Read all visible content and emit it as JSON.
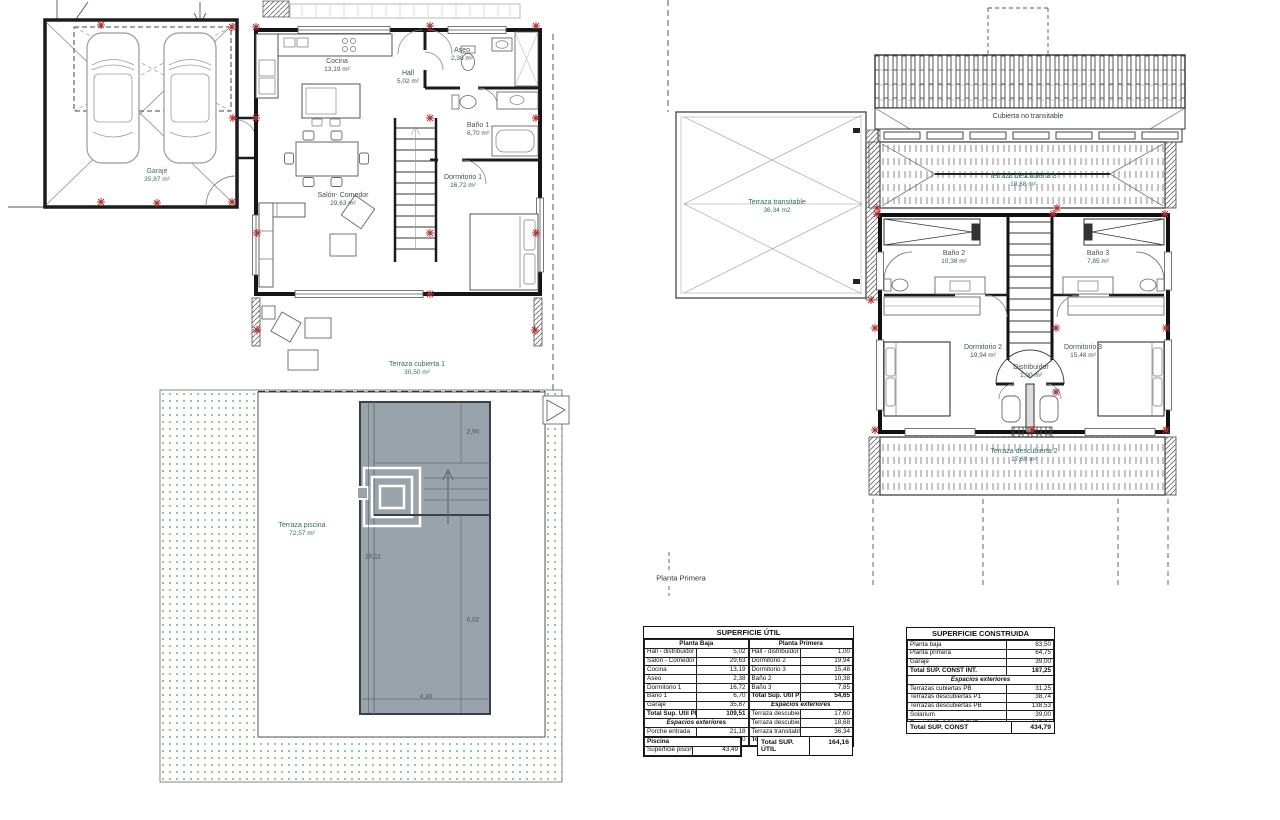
{
  "plans": {
    "ground": {
      "labels": {
        "garaje": {
          "name": "Garaje",
          "area": "35,87 m²"
        },
        "cocina": {
          "name": "Cocina",
          "area": "13,19 m²"
        },
        "hall": {
          "name": "Hall",
          "area": "5,02 m²"
        },
        "aseo": {
          "name": "Aseo",
          "area": "2,38 m²"
        },
        "bano1": {
          "name": "Baño 1",
          "area": "6,70 m²"
        },
        "dormitorio1": {
          "name": "Dormitorio 1",
          "area": "16,72 m²"
        },
        "salon": {
          "name": "Salón- Comedor",
          "area": "29,63 m²"
        },
        "terraza_cubierta1": {
          "name": "Terraza cubierta 1",
          "area": "30,50 m²"
        },
        "terraza_piscina": {
          "name": "Terraza piscina",
          "area": "72,57 m²"
        }
      },
      "pool": {
        "dims": {
          "d1": "2,90",
          "d2": "10,11",
          "d3": "6,02",
          "d4": "4,30"
        }
      }
    },
    "first": {
      "caption": "Planta Primera",
      "labels": {
        "cubierta": {
          "name": "Cubierta no transitable"
        },
        "terraza3": {
          "name": "Terraza descubierta 3",
          "area": "18,68 m²"
        },
        "terraza_transitable": {
          "name": "Terraza transitable",
          "area": "36,34 m2"
        },
        "bano2": {
          "name": "Baño 2",
          "area": "10,38 m²"
        },
        "bano3": {
          "name": "Baño 3",
          "area": "7,85 m²"
        },
        "dormitorio2": {
          "name": "Dormitorio 2",
          "area": "19,94 m²"
        },
        "dormitorio3": {
          "name": "Dormitorio 3",
          "area": "15,48 m²"
        },
        "distribuidor": {
          "name": "Distribuidor",
          "area": "1,00 m²"
        },
        "terraza2": {
          "name": "Terraza descubierta 2",
          "area": "17,60 m²"
        }
      }
    }
  },
  "tables": {
    "superficie_util": {
      "title": "SUPERFICIE ÚTIL",
      "planta_baja": {
        "header": "Planta Baja",
        "rows": [
          {
            "label": "Hall - distribuidor",
            "value": "5,02"
          },
          {
            "label": "Salón - Comedor",
            "value": "29,63"
          },
          {
            "label": "Cocina",
            "value": "13,19"
          },
          {
            "label": "Aseo",
            "value": "2,38"
          },
          {
            "label": "Dormitorio 1",
            "value": "16,72"
          },
          {
            "label": "Baño 1",
            "value": "6,70"
          },
          {
            "label": "Garaje",
            "value": "35,87"
          }
        ],
        "total": {
          "label": "Total Sup. Útil PB",
          "value": "109,51"
        },
        "exteriores_header": "Espacios exteriores",
        "exteriores_rows": [
          {
            "label": "Porche entrada",
            "value": "21,18"
          },
          {
            "label": "Terraza cubierta 1",
            "value": "30,50"
          }
        ]
      },
      "planta_primera": {
        "header": "Planta Primera",
        "rows": [
          {
            "label": "Hall - distribuidor",
            "value": "1,00"
          },
          {
            "label": "Dormitorio 2",
            "value": "19,94"
          },
          {
            "label": "Dormitorio 3",
            "value": "15,48"
          },
          {
            "label": "Baño 2",
            "value": "10,38"
          },
          {
            "label": "Baño 3",
            "value": "7,85"
          }
        ],
        "total": {
          "label": "Total Sup. Útil P1",
          "value": "54,65"
        },
        "exteriores_header": "Espacios exteriores",
        "exteriores_rows": [
          {
            "label": "Terraza descubierta 2",
            "value": "17,60"
          },
          {
            "label": "Terraza descubierta 3",
            "value": "18,68"
          },
          {
            "label": "Terraza transitable",
            "value": "36,34"
          }
        ],
        "total_planta": {
          "label": "Total Planta Primera",
          "value": "127,27"
        }
      }
    },
    "piscina": {
      "header": "Piscina",
      "rows": [
        {
          "label": "Superficie piscina",
          "value": "43,49"
        }
      ]
    },
    "total_util": {
      "label": "Total SUP. ÚTIL",
      "value": "164,16"
    },
    "superficie_construida": {
      "title": "SUPERFICIE CONSTRUIDA",
      "rows": [
        {
          "label": "Planta baja",
          "value": "83,50"
        },
        {
          "label": "Planta primera",
          "value": "64,75"
        },
        {
          "label": "Garaje",
          "value": "39,00"
        }
      ],
      "total_int": {
        "label": "Total SUP. CONST INT.",
        "value": "187,25"
      },
      "exteriores_header": "Espacios exteriores",
      "exteriores_rows": [
        {
          "label": "Terrazas cubiertas PB",
          "value": "31,25"
        },
        {
          "label": "Terrazas descubiertas P1",
          "value": "38,74"
        },
        {
          "label": "Terrazas descubiertas PB",
          "value": "138,53"
        },
        {
          "label": "Solarium",
          "value": "39,00"
        }
      ],
      "total_ext": {
        "label": "Total SUP. CONST EXT.",
        "value": "247,54"
      }
    },
    "total_const": {
      "label": "Total SUP. CONST",
      "value": "434,79"
    }
  }
}
